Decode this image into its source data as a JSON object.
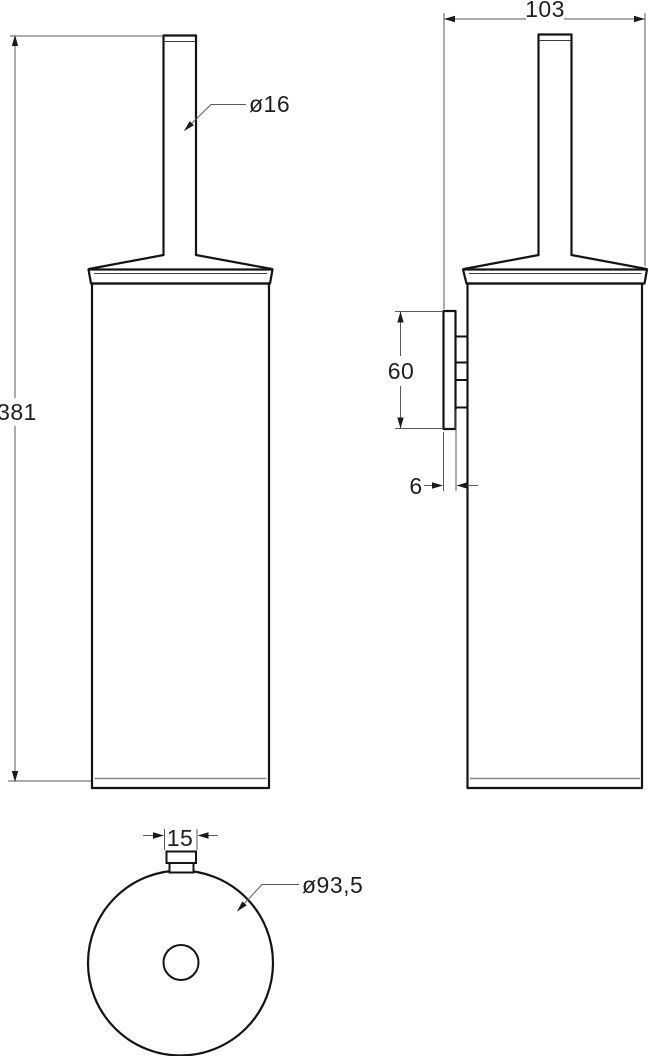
{
  "drawing": {
    "background_color": "#ffffff",
    "line_color": "#141414",
    "thin_line_color": "#5a5a5a",
    "front_view": {
      "height_label": "381",
      "handle_diameter_label": "ø16"
    },
    "side_view": {
      "depth_label": "103",
      "mount_height_label": "60",
      "plate_thickness_label": "6"
    },
    "bottom_view": {
      "knob_width_label": "15",
      "diameter_label": "ø93,5"
    }
  }
}
